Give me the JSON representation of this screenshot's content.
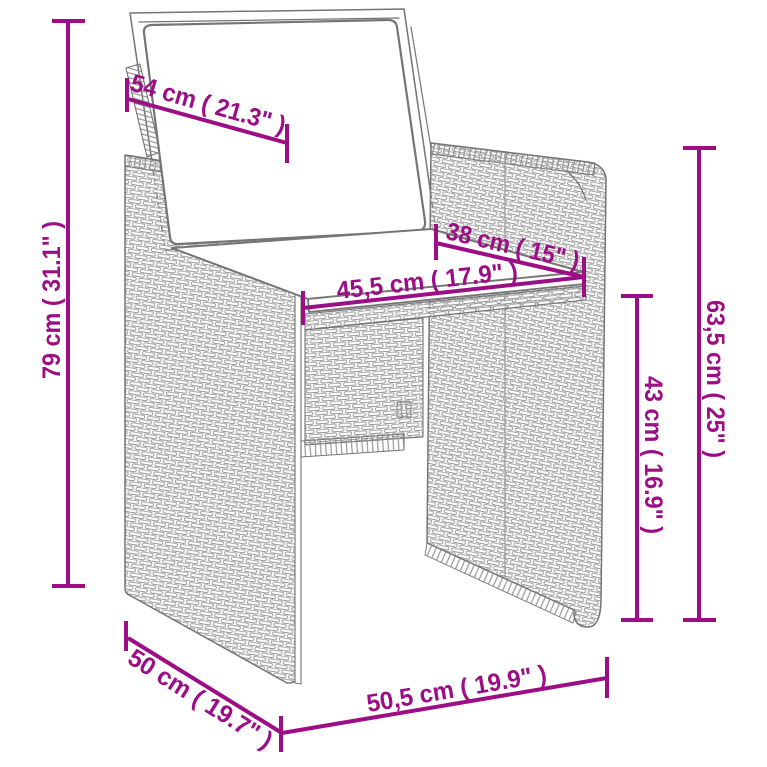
{
  "diagram": {
    "subject": "rattan-armchair-dimension-drawing",
    "colors": {
      "dimension": "#9C0D86",
      "outline": "#757575",
      "weave": "#989898",
      "background": "#ffffff"
    },
    "dimensions": {
      "backrest_width": {
        "label": "54 cm ( 21.3\" )"
      },
      "total_height": {
        "label": "79 cm ( 31.1\" )"
      },
      "seat_depth": {
        "label": "38 cm ( 15\" )"
      },
      "seat_width": {
        "label": "45,5 cm ( 17.9\" )"
      },
      "armrest_height": {
        "label": "63,5 cm ( 25\" )"
      },
      "seat_height": {
        "label": "43 cm ( 16.9\" )"
      },
      "base_depth": {
        "label": "50 cm ( 19.7\" )"
      },
      "base_width": {
        "label": "50,5 cm ( 19.9\" )"
      }
    }
  }
}
